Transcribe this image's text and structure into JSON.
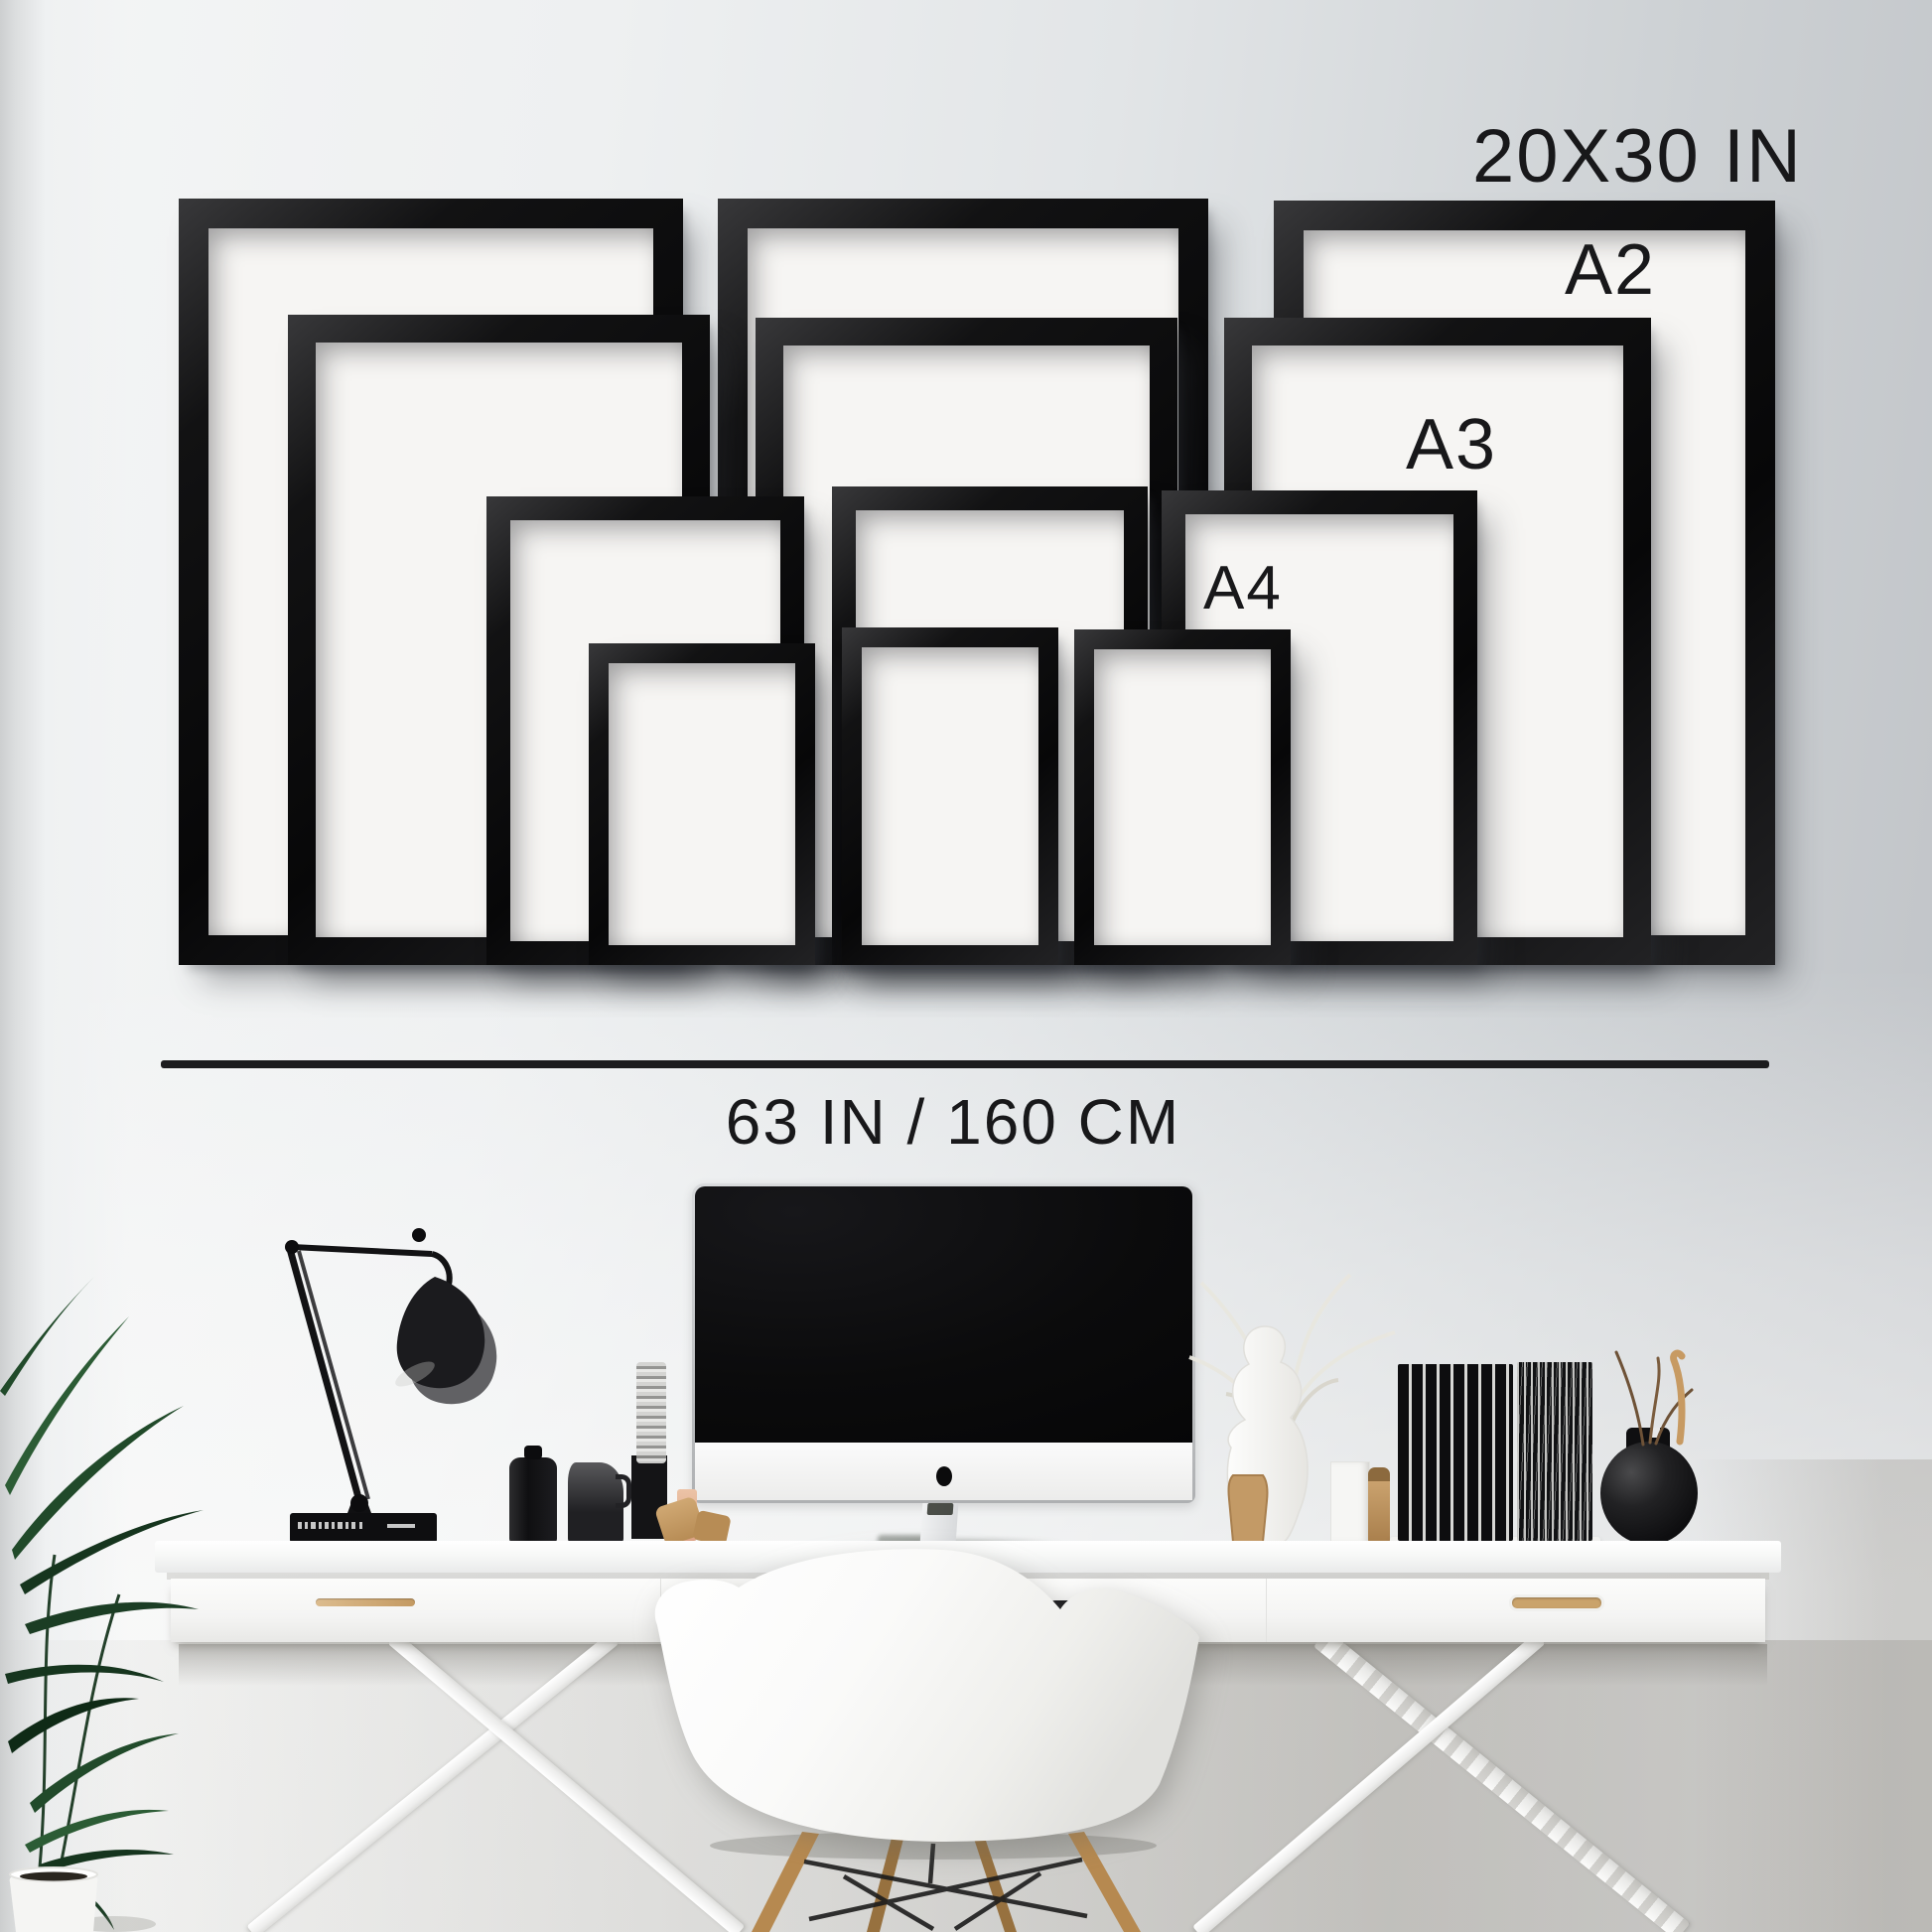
{
  "labels": {
    "size_largest": "20X30 IN",
    "size_a2": "A2",
    "size_a3": "A3",
    "size_a4": "A4",
    "width": "63 IN / 160 CM"
  },
  "palette": {
    "frame_black": "#0c0c0c",
    "frame_mat": "#f6f5f3",
    "wall_light": "#f3f4f5",
    "wall_dark": "#c2c5c8",
    "label_text": "#18181a",
    "divider_line": "#1c1c1e",
    "desk_white": "#fbfbfa",
    "wood_tan": "#b98a52",
    "plant_green": "#2b5232",
    "screen_black": "#0a0a0b"
  },
  "scene_objects": [
    "twelve empty black picture frames on wall in three columns of four sizes",
    "horizontal width measurement line",
    "white desk with drawers and trestle legs",
    "black-screen all-in-one computer",
    "white shell armchair with wooden legs",
    "black articulated desk lamp on black book",
    "green potted plant in white pot",
    "black bottles and vases, records, white vase with dried branches"
  ]
}
